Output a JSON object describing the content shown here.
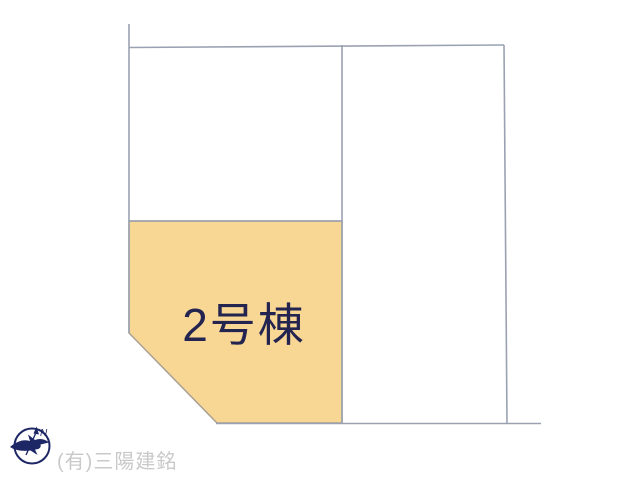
{
  "diagram": {
    "type": "real-estate-lot-plan",
    "highlighted_lot": {
      "label": "2号棟",
      "highlighted": true
    },
    "other_lots": [
      {
        "label": "",
        "note": "upper-left unlabeled parcel"
      },
      {
        "label": "",
        "note": "right unlabeled parcel"
      }
    ],
    "compass": {
      "north_label": "N",
      "style": "circle with bird silhouette and north arrow"
    },
    "watermark": "(有)三陽建銘"
  },
  "colors": {
    "background": "#FFFFFF",
    "boundary_line": "#9AA2B2",
    "lot_fill": "#F8D795",
    "lot_outline": "#A9A094",
    "lot_label_text": "#232450",
    "watermark_text": "#C9C9C9",
    "compass_navy": "#1E2766"
  }
}
